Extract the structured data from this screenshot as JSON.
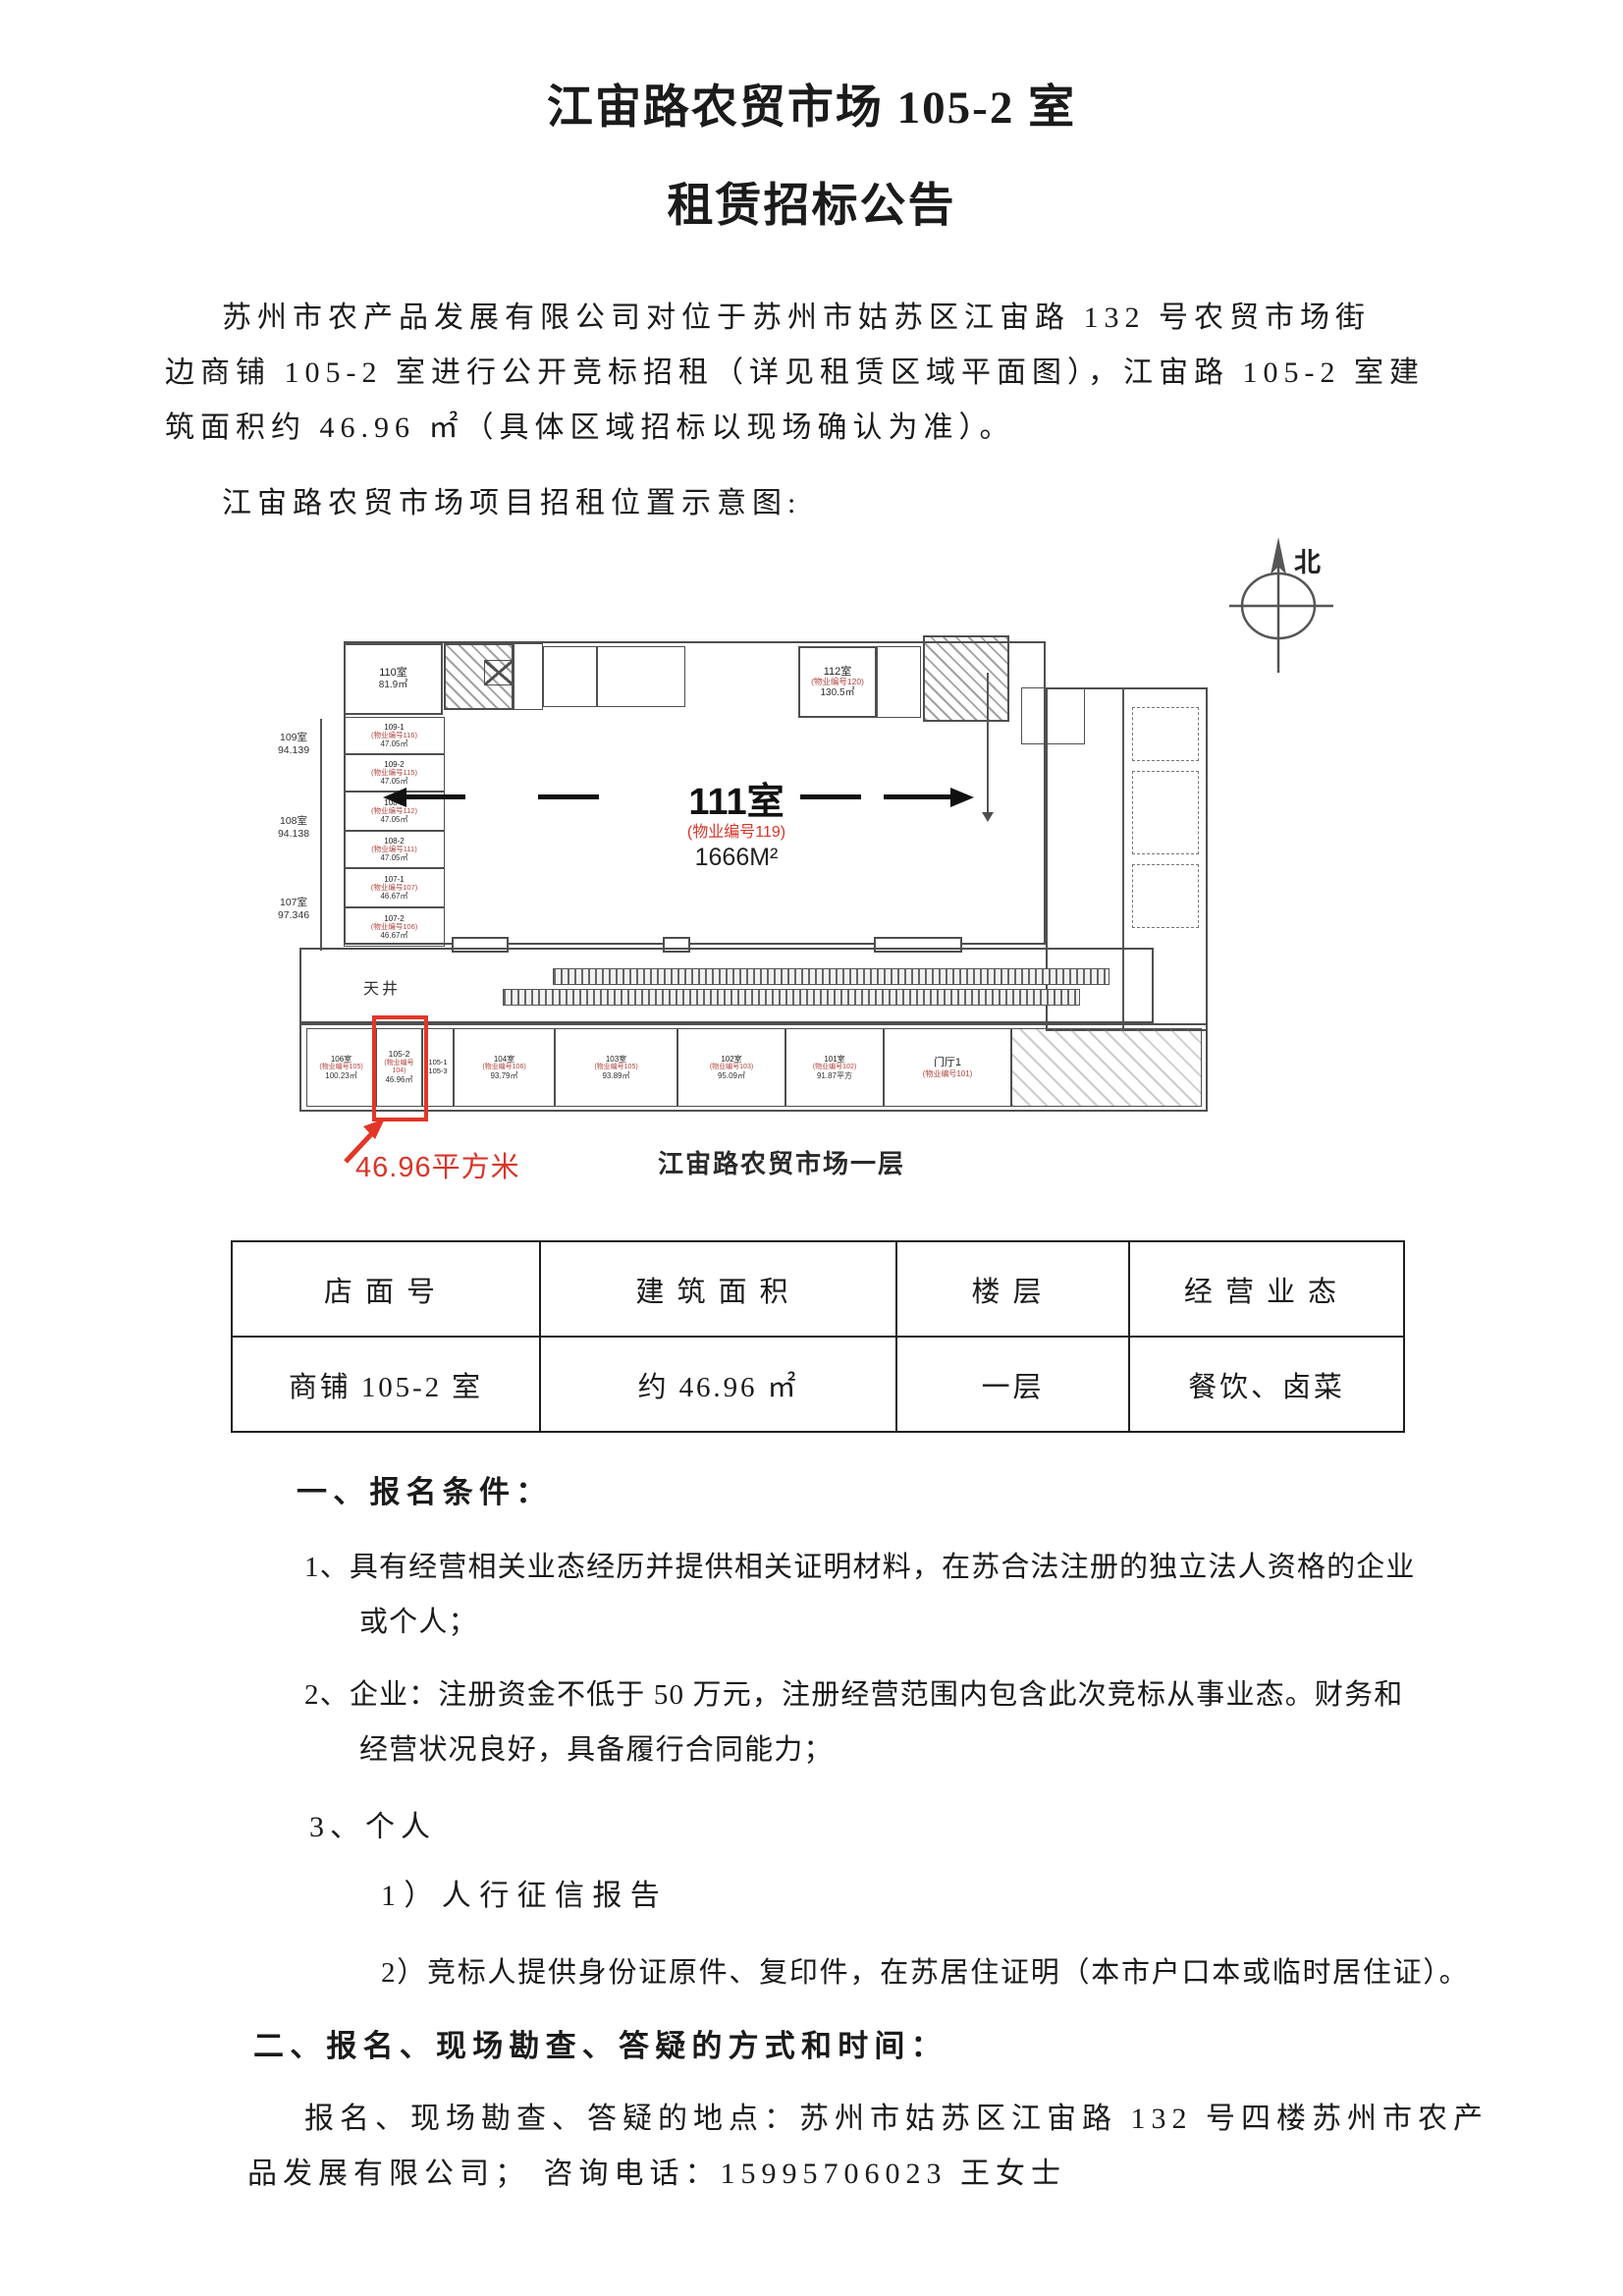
{
  "colors": {
    "accent_red": "#d8362a",
    "plan_line": "#4f4f4f",
    "text": "#1b1b1b"
  },
  "title": {
    "line1": "江宙路农贸市场 105-2 室",
    "line2": "租赁招标公告"
  },
  "intro": {
    "line1": "苏州市农产品发展有限公司对位于苏州市姑苏区江宙路 132 号农贸市场街",
    "line2": "边商铺 105-2 室进行公开竞标招租（详见租赁区域平面图），江宙路 105-2 室建",
    "line3": "筑面积约 46.96 ㎡（具体区域招标以现场确认为准）。"
  },
  "plan_heading": "江宙路农贸市场项目招租位置示意图:",
  "plan": {
    "compass_label": "北",
    "room_110": {
      "name": "110室",
      "area": "81.9㎡"
    },
    "left_rooms": [
      {
        "name": "109-1",
        "prop": "(物业编号116)",
        "area": "47.05㎡"
      },
      {
        "name": "109-2",
        "prop": "(物业编号115)",
        "area": "47.05㎡"
      },
      {
        "name": "108-1",
        "prop": "(物业编号112)",
        "area": "47.05㎡"
      },
      {
        "name": "108-2",
        "prop": "(物业编号111)",
        "area": "47.05㎡"
      },
      {
        "name": "107-1",
        "prop": "(物业编号107)",
        "area": "46.67㎡"
      },
      {
        "name": "107-2",
        "prop": "(物业编号106)",
        "area": "46.67㎡"
      }
    ],
    "dims": [
      {
        "room": "109室",
        "value": "94.139"
      },
      {
        "room": "108室",
        "value": "94.138"
      },
      {
        "room": "107室",
        "value": "97.346"
      }
    ],
    "hall": {
      "name": "111室",
      "prop": "(物业编号119)",
      "area": "1666M²"
    },
    "room_112": {
      "name": "112室",
      "prop": "(物业编号120)",
      "area": "130.5㎡"
    },
    "courtyard": "天井",
    "shops": [
      {
        "name": "106室",
        "prop": "(物业编号105)",
        "area": "100.23㎡"
      },
      {
        "name": "105-2",
        "prop": "(物业编号",
        "prop2": "104)",
        "area": "46.96㎡"
      },
      {
        "name": "105-1",
        "name2": "105-3"
      },
      {
        "name": "104室",
        "prop": "(物业编号106)",
        "area": "93.79㎡"
      },
      {
        "name": "103室",
        "prop": "(物业编号105)",
        "area": "93.89㎡"
      },
      {
        "name": "102室",
        "prop": "(物业编号103)",
        "area": "95.09㎡"
      },
      {
        "name": "101室",
        "prop": "(物业编号102)",
        "area": "91.87平方"
      },
      {
        "name": "门厅1",
        "prop": "(物业编号101)"
      }
    ],
    "highlight_note": "46.96平方米",
    "caption": "江宙路农贸市场一层"
  },
  "table": {
    "headers": [
      "店面号",
      "建筑面积",
      "楼层",
      "经营业态"
    ],
    "rows": [
      [
        "商铺 105-2 室",
        "约 46.96 ㎡",
        "一层",
        "餐饮、卤菜"
      ]
    ]
  },
  "sections": {
    "s1_heading": "一、报名条件：",
    "item1_line1": "1、具有经营相关业态经历并提供相关证明材料，在苏合法注册的独立法人资格的企业",
    "item1_line2": "或个人；",
    "item2_line1": "2、企业：注册资金不低于 50 万元，注册经营范围内包含此次竞标从事业态。财务和",
    "item2_line2": "经营状况良好，具备履行合同能力；",
    "item3": "3、个人",
    "sub1": "1）人行征信报告",
    "sub2": "2）竞标人提供身份证原件、复印件，在苏居住证明（本市户口本或临时居住证）。",
    "s2_heading": "二、报名、现场勘查、答疑的方式和时间：",
    "final_line1": "报名、现场勘查、答疑的地点：苏州市姑苏区江宙路 132 号四楼苏州市农产",
    "final_line2": "品发展有限公司；  咨询电话：15995706023 王女士"
  }
}
